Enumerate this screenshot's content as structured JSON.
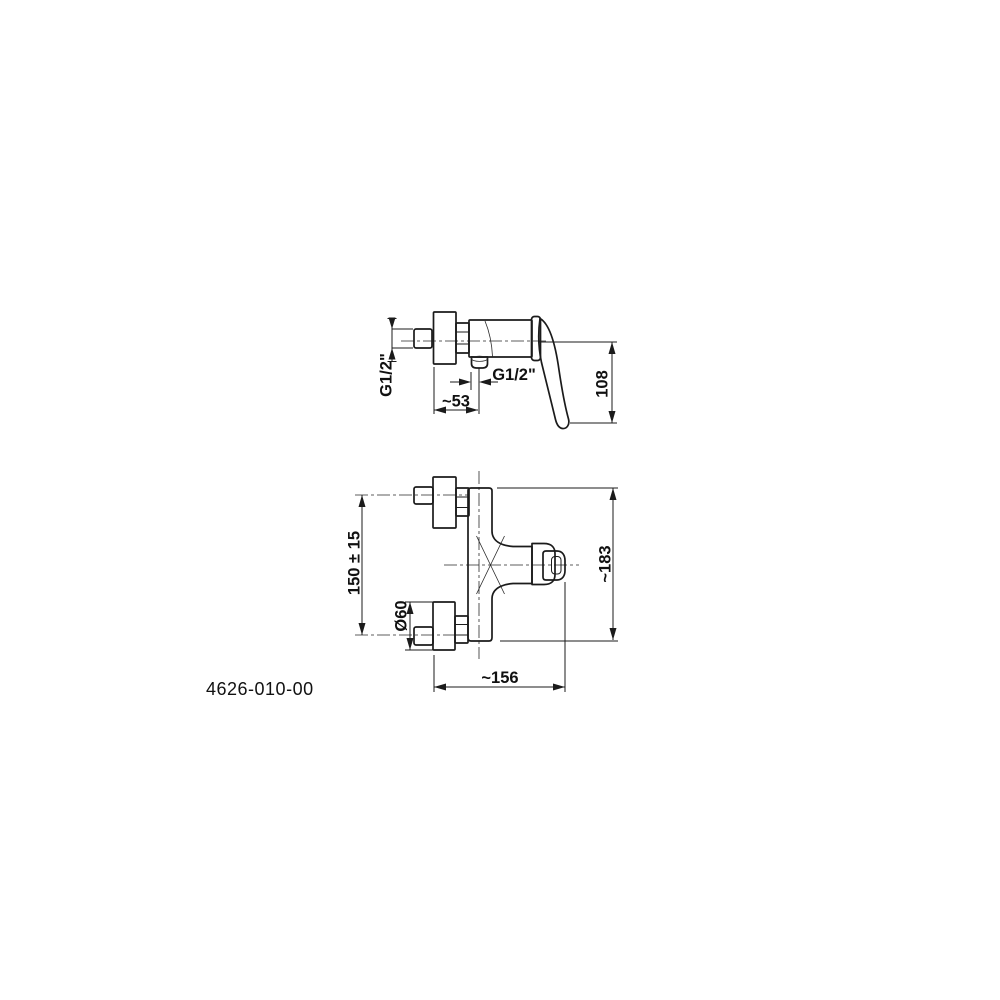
{
  "drawing": {
    "product_code": "4626-010-00",
    "colors": {
      "line": "#1b1b1b",
      "background": "#ffffff"
    },
    "side_view": {
      "labels": {
        "inlet_thread": "G1/2\"",
        "outlet_thread": "G1/2\"",
        "wall_to_outlet": "~53",
        "axis_to_handle_tip": "108"
      }
    },
    "front_view": {
      "labels": {
        "connection_spacing": "150 ± 15",
        "flange_diameter": "Ø60",
        "overall_height": "~183",
        "overall_depth": "~156"
      }
    }
  }
}
